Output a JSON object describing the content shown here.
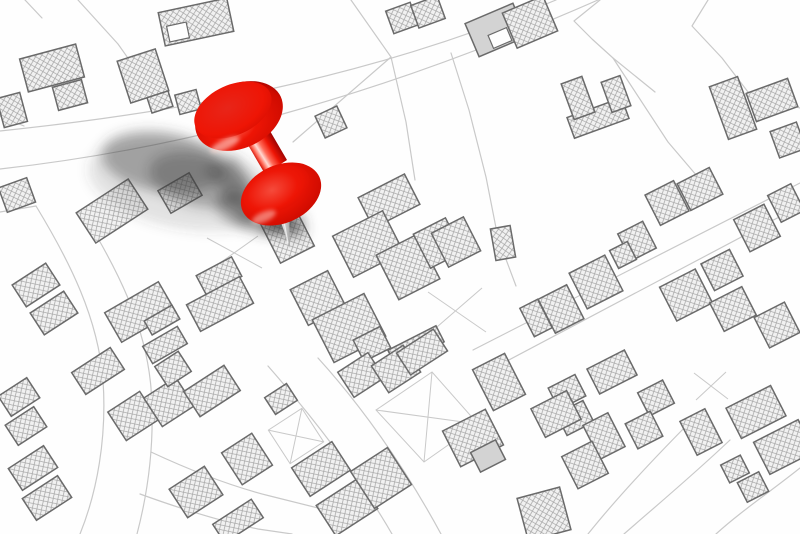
{
  "scene": {
    "kind": "cadastral map illustration with a red pushpin marking a location",
    "pin_label": "location-pushpin"
  },
  "colors": {
    "background": "#fefefe",
    "parcel-line": "#c9c9c9",
    "building-outline": "#6a6a6a",
    "building-fill": "#f1f1f1",
    "building-hatch": "#a6a6a6",
    "building-plain": "#d3d3d3",
    "pin-red": "#ee1505",
    "pin-red-bright": "#ff6a58",
    "pin-red-top": "#e82519",
    "pin-red-mid": "#cf0b00",
    "pin-red-dark": "#8f0000",
    "pin-specular": "#ffd9d2",
    "needle-light": "#f5f5f5",
    "needle-mid": "#d6d6d6",
    "needle-dark": "#9f9f9f",
    "shadow": "#3c3c3c"
  }
}
